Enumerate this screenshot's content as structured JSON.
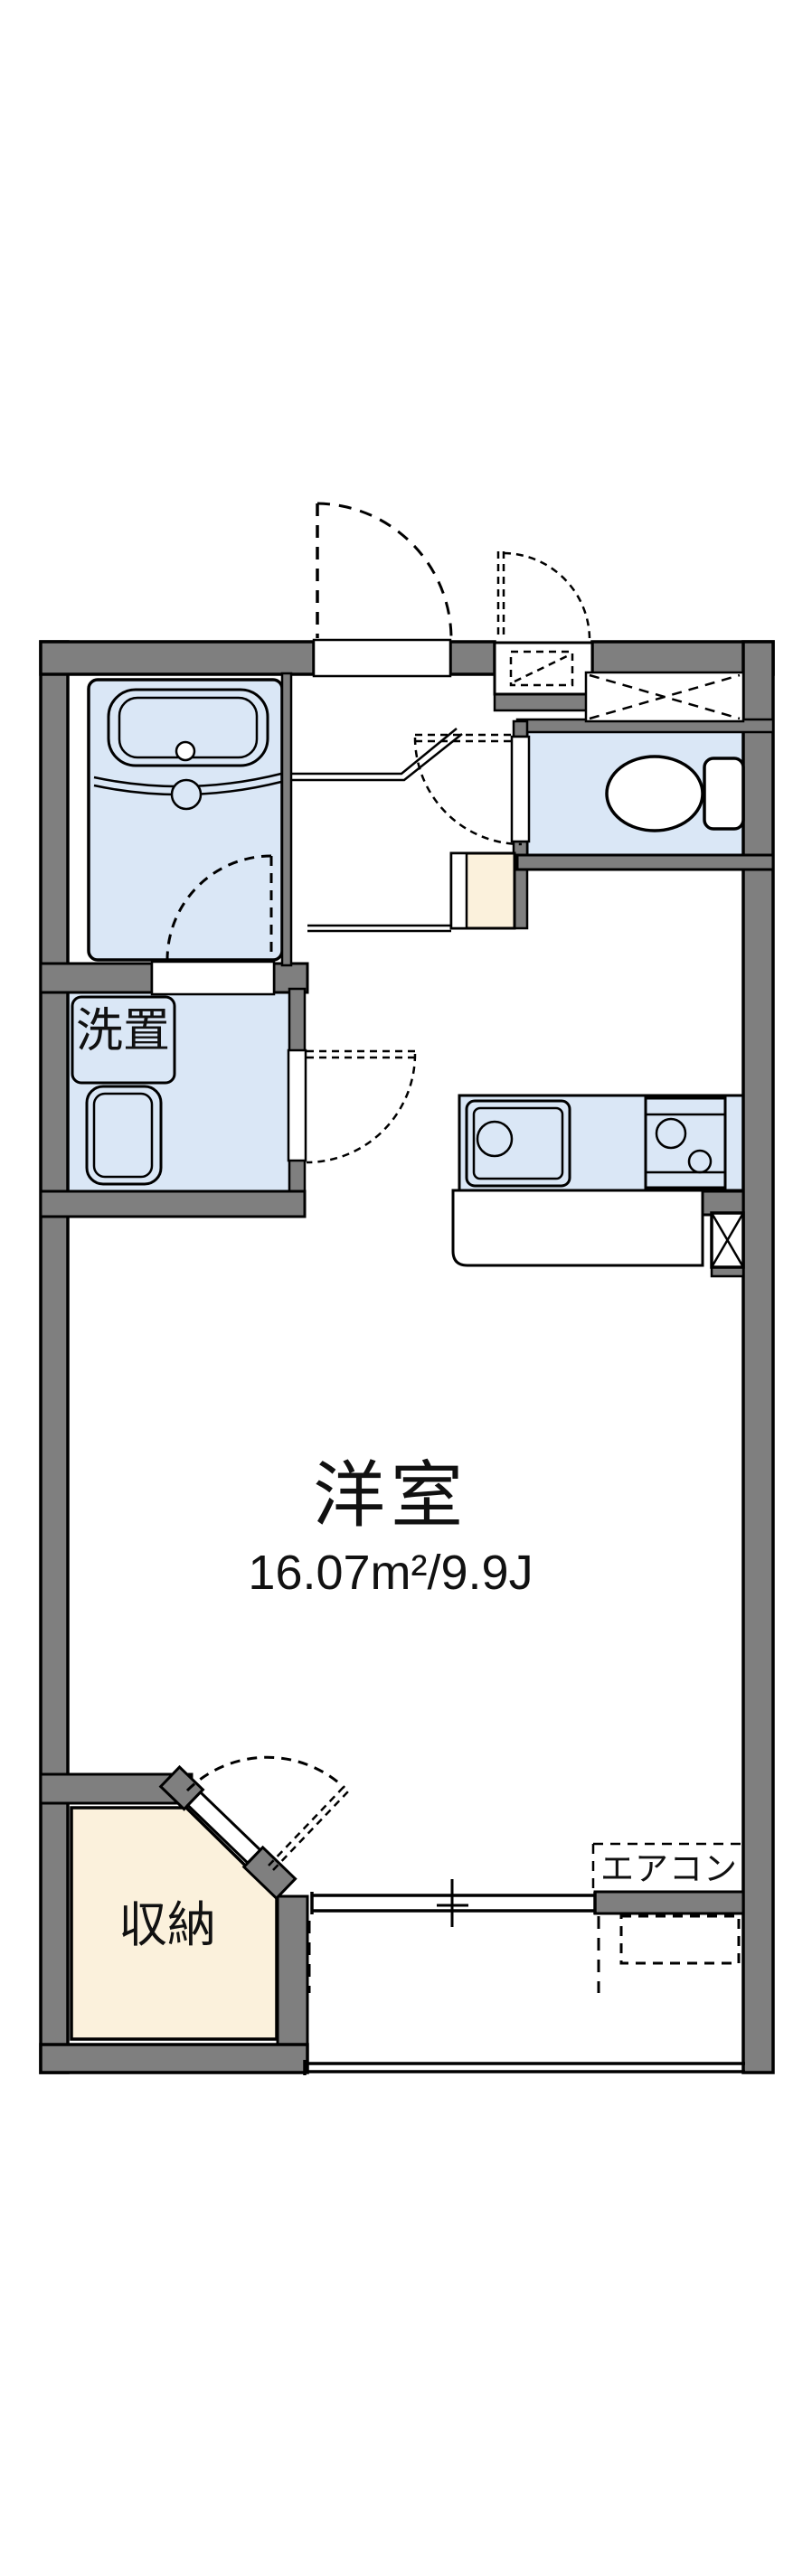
{
  "title": "apartment-floor-plan",
  "colors": {
    "wall": "#7f7f7f",
    "outline": "#000000",
    "room_blue": "#dae7f6",
    "cream": "#fbf1dc",
    "white": "#ffffff",
    "text": "#111111"
  },
  "rooms": {
    "main_room": {
      "label": "洋室",
      "area": "16.07m²/9.9J"
    },
    "laundry": {
      "label": "洗置"
    },
    "storage": {
      "label": "収納"
    },
    "aircon": {
      "label": "エアコン"
    }
  }
}
